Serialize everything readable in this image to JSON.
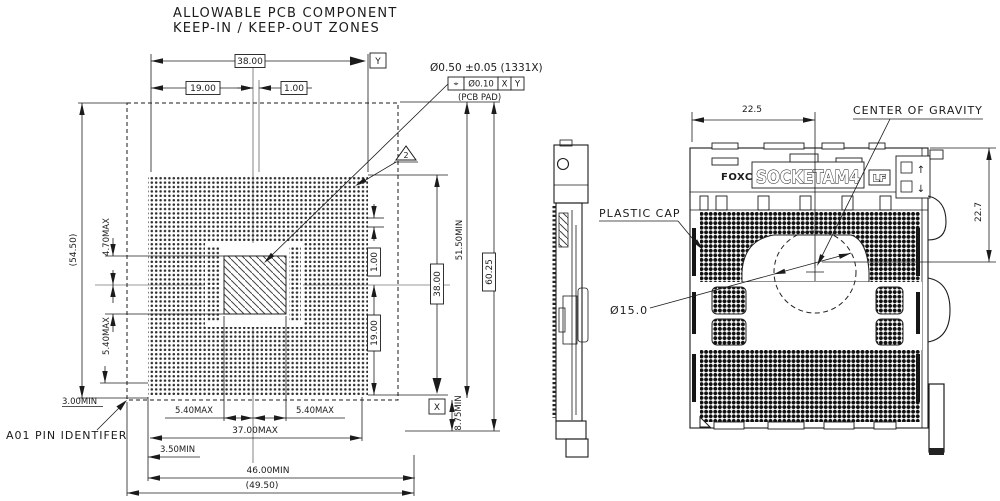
{
  "title": {
    "line1": "ALLOWABLE PCB COMPONENT",
    "line2": "KEEP-IN / KEEP-OUT ZONES"
  },
  "callout": {
    "pad_size": "Ø0.50 ±0.05 (1331X)",
    "gdt_symbol": "⌖",
    "gdt_tolerance": "Ø0.10",
    "gdt_datum_1": "X",
    "gdt_datum_2": "Y",
    "pad_note": "(PCB PAD)"
  },
  "flag_note": "2",
  "datum_x": "X",
  "datum_y": "Y",
  "pcb_dims": {
    "top_width": "38.00",
    "top_half": "19.00",
    "top_offset": "1.00",
    "left_overall": "(54.50)",
    "keepin_top": "4.70MAX",
    "keepin_bottom": "5.40MAX",
    "bottom_margin": "3.00MIN",
    "bottom_left": "5.40MAX",
    "bottom_right": "5.40MAX",
    "component_max": "37.00MAX",
    "edge_min": "3.50MIN",
    "width_min": "46.00MIN",
    "overall_width": "(49.50)",
    "right_offset": "1.00",
    "right_half": "19.00",
    "right_width": "38.00",
    "keepout_min": "51.50MIN",
    "overall_height": "60.25",
    "bottom_clear": "8.75MIN"
  },
  "labels": {
    "pin_id": "A01 PIN IDENTIFER",
    "plastic_cap": "PLASTIC CAP",
    "center_of_gravity": "CENTER OF GRAVITY",
    "cap_diameter": "Ø15.0"
  },
  "socket": {
    "brand": "FOXCONN",
    "model": "SOCKETAM4",
    "lf": "LF",
    "dim_half": "22.5",
    "dim_cog": "22.7",
    "unlock_arrow": "↑",
    "lock_arrow": "↓"
  }
}
